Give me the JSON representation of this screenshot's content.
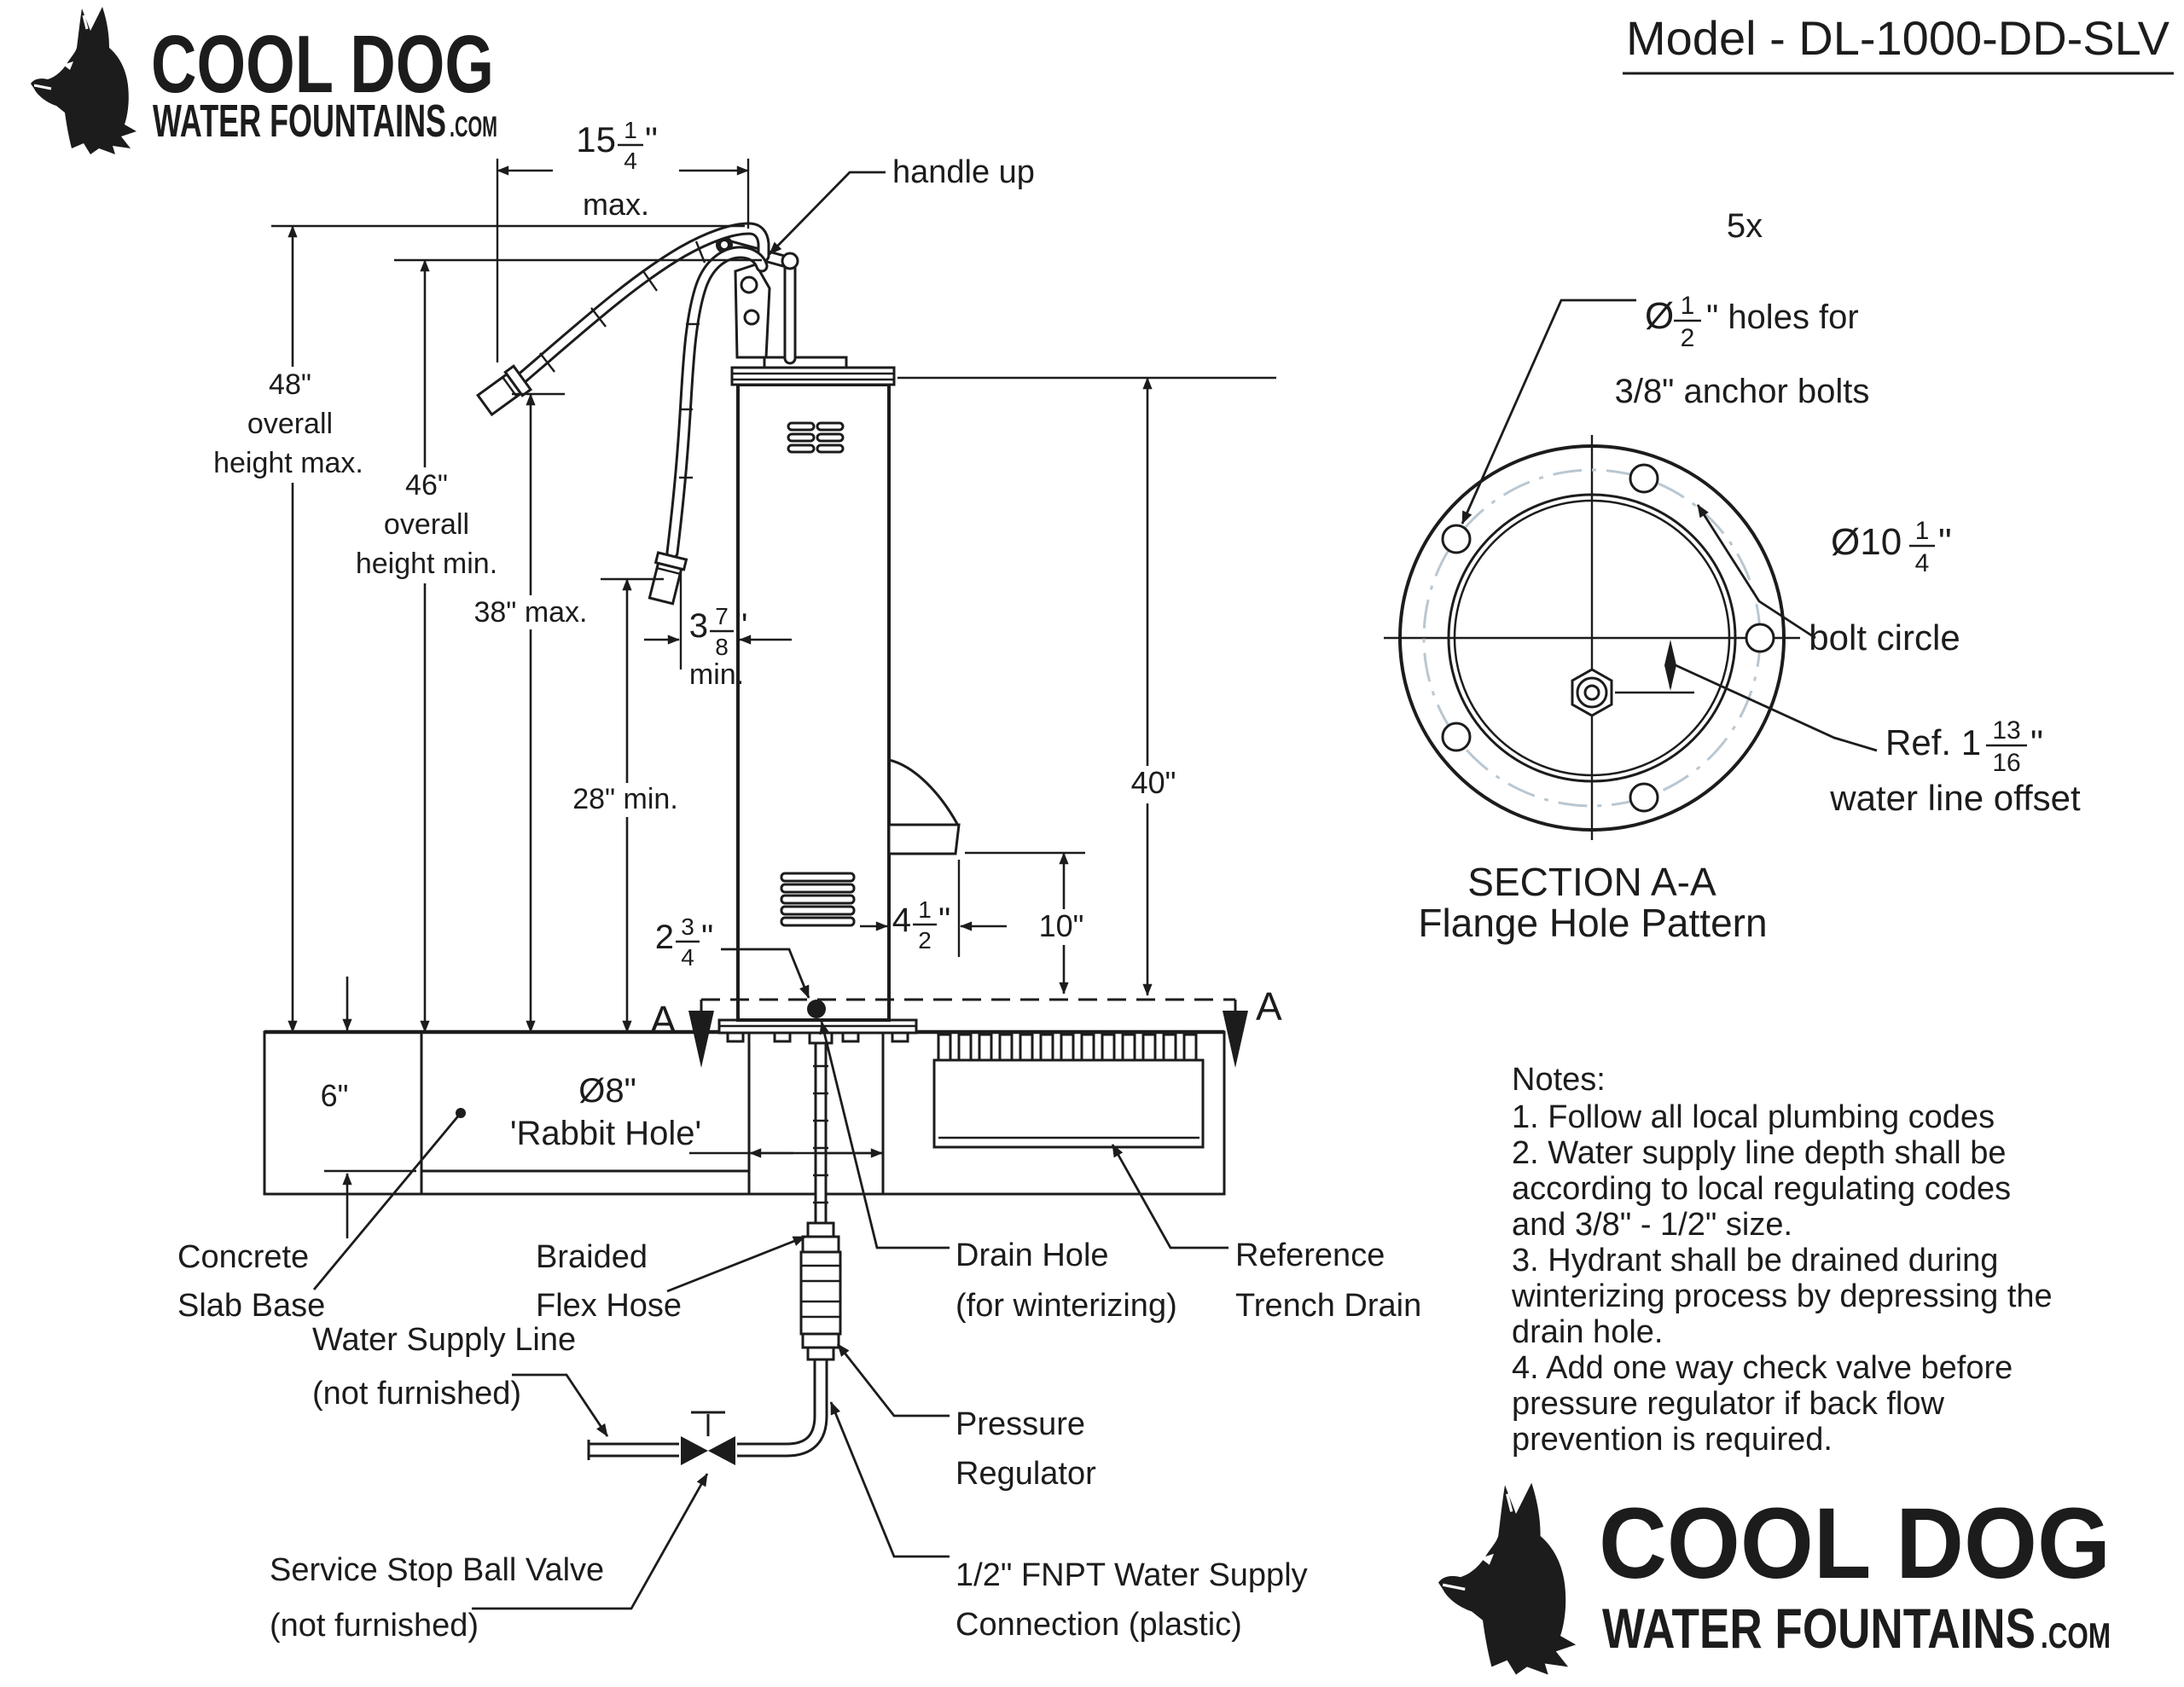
{
  "logo": {
    "title": "COOL DOG",
    "subtitle": "WATER FOUNTAINS",
    "suffix": ".COM",
    "blue": "#3a98cc"
  },
  "model": {
    "label": "Model - DL-1000-DD-SLV"
  },
  "dims": {
    "top_width_whole": "15",
    "top_width_num": "1",
    "top_width_den": "4",
    "top_width_unit": "\"",
    "top_width_qual": "max.",
    "h48": "48\"",
    "h48_l2": "overall",
    "h48_l3": "height max.",
    "h46": "46\"",
    "h46_l2": "overall",
    "h46_l3": "height min.",
    "h38": "38\" max.",
    "h28": "28\" min.",
    "gap_whole": "3",
    "gap_num": "7",
    "gap_den": "8",
    "gap_unit": "\"",
    "gap_qual": "min.",
    "drain_whole": "2",
    "drain_num": "3",
    "drain_den": "4",
    "drain_unit": "\"",
    "spout_whole": "4",
    "spout_num": "1",
    "spout_den": "2",
    "spout_unit": "\"",
    "h10": "10\"",
    "h40": "40\"",
    "slab6": "6\"",
    "rabbit1": "Ø8\"",
    "rabbit2": "'Rabbit Hole'"
  },
  "labels": {
    "handle_up": "handle up",
    "concrete1": "Concrete",
    "concrete2": "Slab Base",
    "braided1": "Braided",
    "braided2": "Flex Hose",
    "supply1": "Water Supply Line",
    "supply2": "(not furnished)",
    "valve1": "Service Stop Ball Valve",
    "valve2": "(not furnished)",
    "drain1": "Drain Hole",
    "drain2": "(for winterizing)",
    "trench1": "Reference",
    "trench2": "Trench Drain",
    "reg1": "Pressure",
    "reg2": "Regulator",
    "fnpt1": "1/2\" FNPT Water Supply",
    "fnpt2": "Connection (plastic)",
    "section_a": "A"
  },
  "flange": {
    "count": "5x",
    "hole_prefix": "Ø",
    "hole_num": "1",
    "hole_den": "2",
    "hole_suffix": "\" holes for",
    "hole_l2": "3/8\" anchor bolts",
    "bc_prefix": "Ø10",
    "bc_num": "1",
    "bc_den": "4",
    "bc_suffix": "\"",
    "bc_l2": "bolt circle",
    "ref_prefix": "Ref. 1",
    "ref_num": "13",
    "ref_den": "16",
    "ref_suffix": "\"",
    "ref_l2": "water line offset",
    "section": "SECTION A-A",
    "pattern": "Flange Hole Pattern"
  },
  "notes": {
    "heading": "Notes:",
    "lines": [
      "1. Follow all local plumbing codes",
      "2. Water supply line depth shall be",
      "according to local regulating codes",
      "and 3/8\" - 1/2\" size.",
      "3. Hydrant shall be drained during",
      "winterizing process by depressing the",
      "drain hole.",
      "4. Add one way check valve before",
      "pressure regulator if back flow",
      "prevention is required."
    ]
  }
}
